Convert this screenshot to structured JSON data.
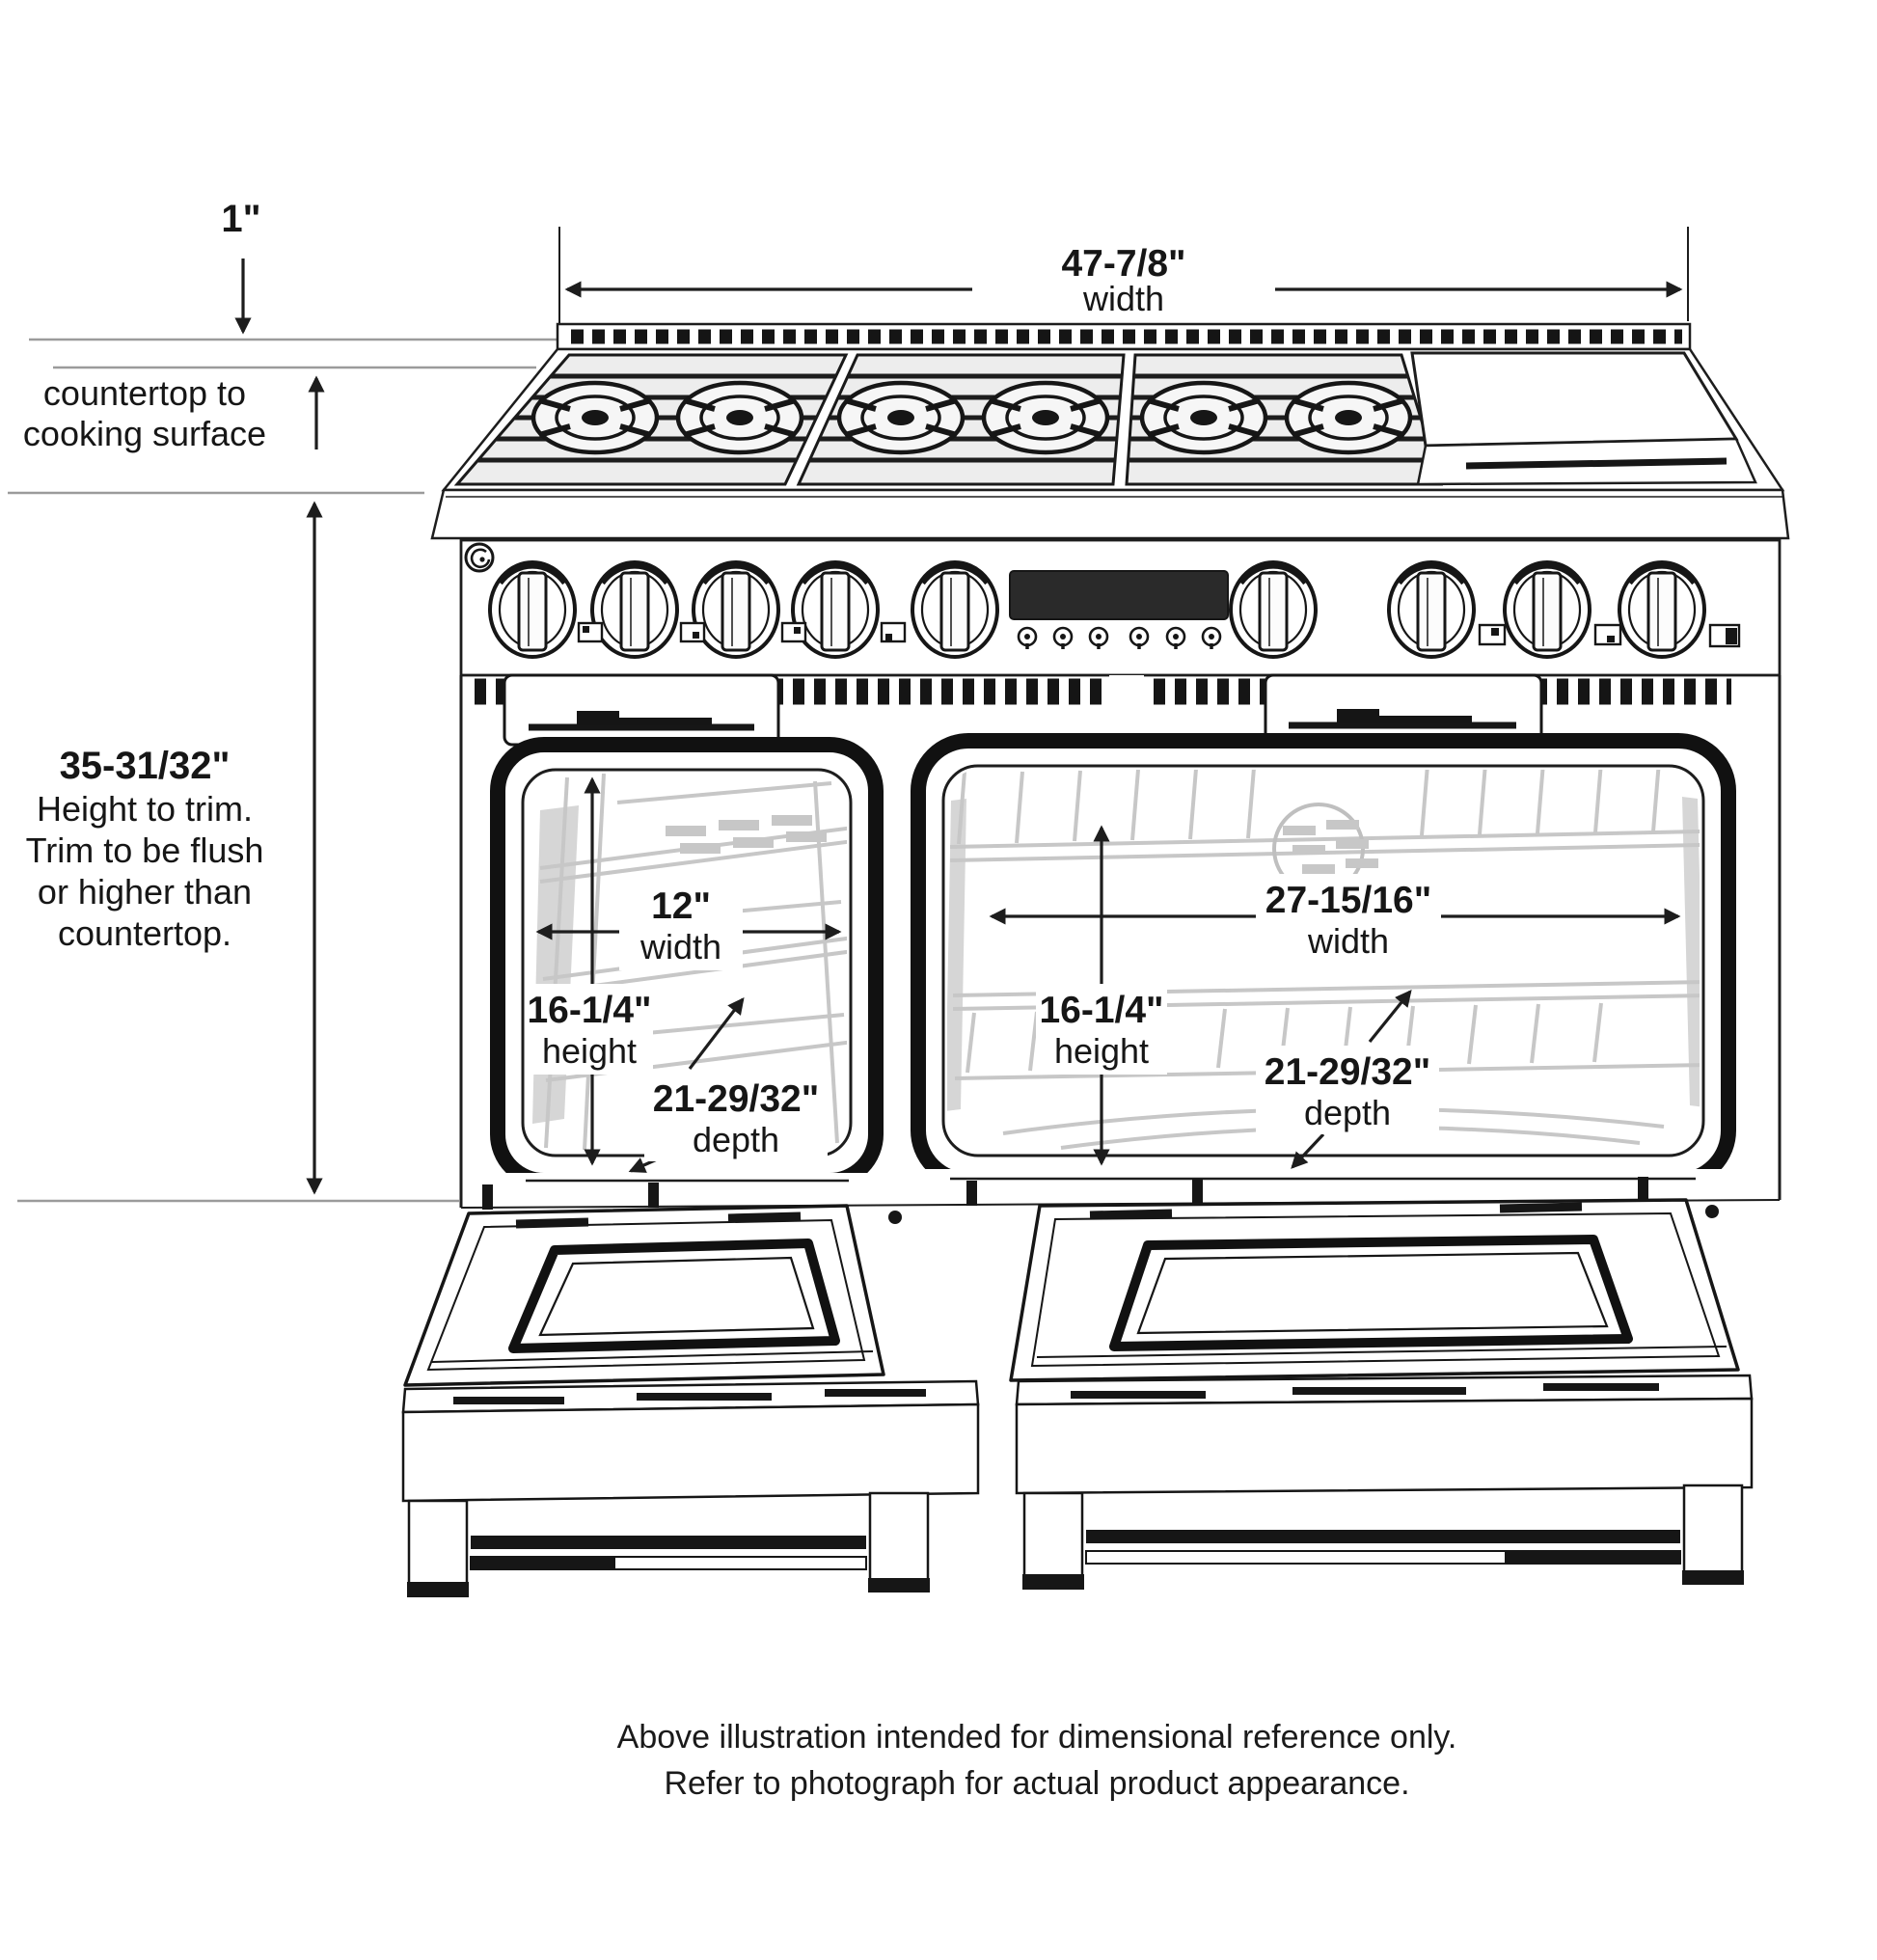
{
  "colors": {
    "ink": "#1d1d1d",
    "reference_line": "#9b9b9b",
    "rack_gray": "#c7c7c7",
    "display_black": "#2a2a2a",
    "paper": "#ffffff"
  },
  "annotations": {
    "top_offset": {
      "value": "1\""
    },
    "overall_width": {
      "value": "47-7/8\"",
      "unit": "width"
    },
    "countertop": {
      "line1": "countertop to",
      "line2": "cooking surface"
    },
    "height_to_trim": {
      "value": "35-31/32\"",
      "note1": "Height to trim.",
      "note2": "Trim to be flush",
      "note3": "or higher than",
      "note4": "countertop."
    },
    "left_oven": {
      "width": {
        "value": "12\"",
        "unit": "width"
      },
      "height": {
        "value": "16-1/4\"",
        "unit": "height"
      },
      "depth": {
        "value": "21-29/32\"",
        "unit": "depth"
      }
    },
    "right_oven": {
      "width": {
        "value": "27-15/16\"",
        "unit": "width"
      },
      "height": {
        "value": "16-1/4\"",
        "unit": "height"
      },
      "depth": {
        "value": "21-29/32\"",
        "unit": "depth"
      }
    }
  },
  "caption": {
    "line1": "Above illustration intended for dimensional reference only.",
    "line2": "Refer to photograph for actual product appearance."
  }
}
